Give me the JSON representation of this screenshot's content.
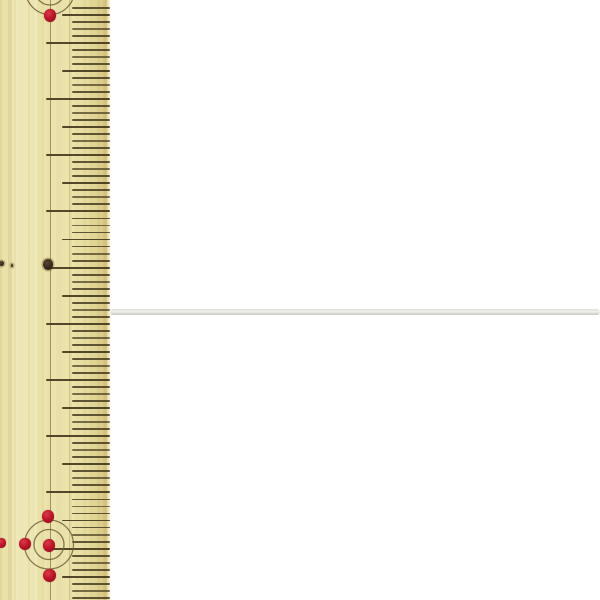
{
  "scene": {
    "background_color": "#ffffff",
    "subject": "thin white cord photographed beside a wooden ruler for scale"
  },
  "ruler": {
    "x": 0,
    "width": 111,
    "height": 600,
    "wood_color": "#ece4ad",
    "edge_band_color": "#d2c178",
    "tick_color": "#453a1e",
    "ticks": {
      "start_y": 7.7,
      "spacing": 7.025,
      "count": 85,
      "right_x": 110,
      "short_left_x": 72,
      "medium_left_x": 62,
      "long_left_x": 46,
      "period": 8,
      "long_phase": 5,
      "medium_phase": 1,
      "thickness": 1.9
    },
    "guide_lines": [
      {
        "x": 50.2,
        "width": 1.2,
        "color": "#8a7747",
        "opacity": 0.75
      },
      {
        "x": 69.5,
        "width": 1.0,
        "color": "#a89358",
        "opacity": 0.38
      }
    ],
    "red_dots": [
      {
        "x": 50,
        "y": 15,
        "r": 6.5
      },
      {
        "x": 48,
        "y": 516,
        "r": 6.5
      },
      {
        "x": 25,
        "y": 544,
        "r": 6.0
      },
      {
        "x": 49,
        "y": 545,
        "r": 6.5
      },
      {
        "x": 1.5,
        "y": 543,
        "r": 5.0
      },
      {
        "x": 49.5,
        "y": 575,
        "r": 6.5
      }
    ],
    "dark_dots": [
      {
        "x": 48,
        "y": 264,
        "r": 5.5
      },
      {
        "x": 1.5,
        "y": 263,
        "r": 2.5
      },
      {
        "x": 12,
        "y": 265,
        "r": 1.5
      }
    ],
    "red_dot_color": "#bb1428",
    "dark_dot_color": "#33261a",
    "circle_marks": [
      {
        "cx": 50,
        "cy": -10,
        "radii": [
          15,
          24.5
        ]
      },
      {
        "cx": 49,
        "cy": 544.5,
        "radii": [
          15,
          24.5
        ]
      }
    ],
    "circle_color": "#6d5c36"
  },
  "cord": {
    "x": 110,
    "y": 308.5,
    "length": 490,
    "thickness": 6,
    "color_top": "#dededa",
    "color_mid": "#f1f1ec",
    "color_bottom": "#c8c8c0"
  }
}
